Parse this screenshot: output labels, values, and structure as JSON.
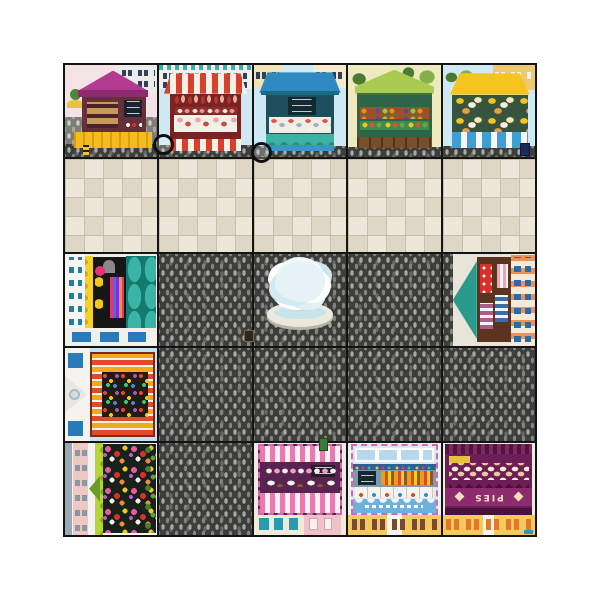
{
  "scene": {
    "type": "playmat",
    "name": "Market Town Play Mat",
    "grid_rows": 5,
    "grid_cols": 5,
    "margin_color": "#ffffff",
    "gridline_color": "#141414"
  },
  "labels": {
    "pies_sign": "PIES"
  },
  "tiles": [
    {
      "row": 1,
      "col": 1,
      "name": "bakery-stall",
      "desc": "magenta tent stall with bread shelves, menu boards and yellow counter"
    },
    {
      "row": 1,
      "col": 2,
      "name": "butcher-stall",
      "desc": "red and white striped stall with hanging meats and deli counter"
    },
    {
      "row": 1,
      "col": 3,
      "name": "fish-stall",
      "desc": "blue canopy stall with chalkboard menu, iced fish counter and teal wave skirt"
    },
    {
      "row": 1,
      "col": 4,
      "name": "greengrocer-stall",
      "desc": "green canopy stall with hanging bananas and crates of fruit and vegetables"
    },
    {
      "row": 1,
      "col": 5,
      "name": "cheese-stall",
      "desc": "yellow canopy stall with cheeses and blue striped counter"
    },
    {
      "row": 2,
      "col": 1,
      "name": "plaza-paving",
      "desc": "pale stone paving"
    },
    {
      "row": 2,
      "col": 2,
      "name": "plaza-paving",
      "desc": "pale stone paving"
    },
    {
      "row": 2,
      "col": 3,
      "name": "plaza-paving",
      "desc": "pale stone paving"
    },
    {
      "row": 2,
      "col": 4,
      "name": "plaza-paving",
      "desc": "pale stone paving"
    },
    {
      "row": 2,
      "col": 5,
      "name": "plaza-paving",
      "desc": "pale stone paving"
    },
    {
      "row": 3,
      "col": 1,
      "name": "candy-shop",
      "desc": "sweet shop facing right with yellow trim, dark interior of candies and teal canopy"
    },
    {
      "row": 3,
      "col": 2,
      "name": "cobbled-square",
      "desc": "dark cobblestones"
    },
    {
      "row": 3,
      "col": 3,
      "name": "fountain-square",
      "desc": "stone fountain with splashing water on cobblestones"
    },
    {
      "row": 3,
      "col": 4,
      "name": "cobbled-square",
      "desc": "dark cobblestones"
    },
    {
      "row": 3,
      "col": 5,
      "name": "clothes-shop",
      "desc": "clothes shop facing left with teal awning, dresses and folded fabric"
    },
    {
      "row": 4,
      "col": 1,
      "name": "newsagent-shop",
      "desc": "shop facing right with red and orange striped awning and magazine display"
    },
    {
      "row": 4,
      "col": 2,
      "name": "cobbled-square",
      "desc": "dark cobblestones"
    },
    {
      "row": 4,
      "col": 3,
      "name": "cobbled-square",
      "desc": "dark cobblestones"
    },
    {
      "row": 4,
      "col": 4,
      "name": "cobbled-square",
      "desc": "dark cobblestones"
    },
    {
      "row": 4,
      "col": 5,
      "name": "cobbled-square",
      "desc": "dark cobblestones"
    },
    {
      "row": 5,
      "col": 1,
      "name": "flower-shop",
      "desc": "florist facing right with green scalloped awning and banks of colourful flowers"
    },
    {
      "row": 5,
      "col": 2,
      "name": "cobbled-square",
      "desc": "dark cobblestones"
    },
    {
      "row": 5,
      "col": 3,
      "name": "cake-shop",
      "desc": "upside-down pink striped cake shop with cupcakes, facing the square"
    },
    {
      "row": 5,
      "col": 4,
      "name": "toy-shop",
      "desc": "upside-down blue toy shop with skylights, display cases and scalloped awning"
    },
    {
      "row": 5,
      "col": 5,
      "name": "pie-shop",
      "desc": "upside-down purple pie shop with PIES sign and rows of pies"
    }
  ],
  "landmarks": {
    "fountain": "round stone fountain with water plume",
    "connector_rings": 2,
    "street_markers": [
      "yellow post top-left stall",
      "navy sign right of cheese stall",
      "dark plaque near fountain",
      "green crate on cobbles"
    ]
  },
  "colors": {
    "bakery_tent": "#b23a90",
    "butcher_stripe": "#d8402e",
    "fish_canopy": "#2f8ac2",
    "greengrocer_canopy": "#a9cc50",
    "cheese_canopy": "#f5c51e",
    "candy_canopy_teal": "#2aa195",
    "cake_stripe": "#e87ab0",
    "toyshop_awning": "#6cb2dc",
    "pieshop_purple": "#6e1e56",
    "paving_light": "#ebe6d8",
    "cobble_dark": "#3d3d3b",
    "sky": "#cfe9f4"
  }
}
